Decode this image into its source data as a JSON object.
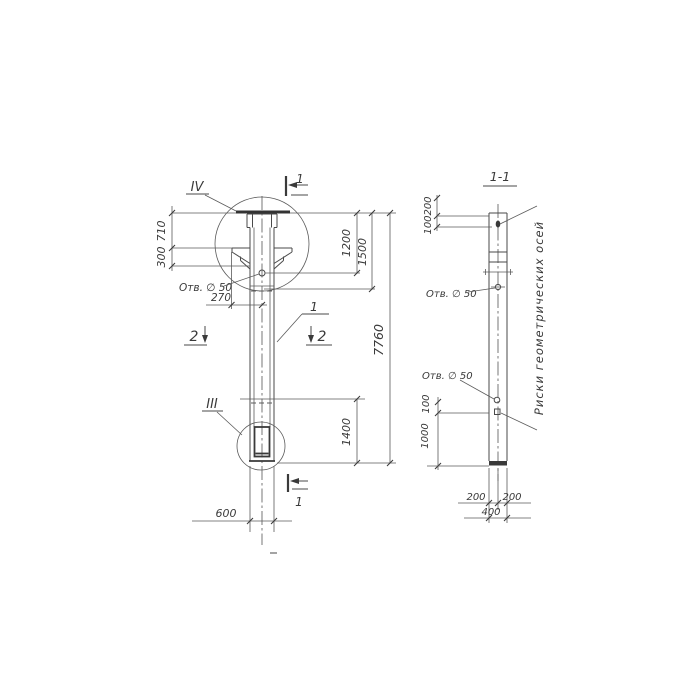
{
  "drawing": {
    "ink": "#3a3a3a",
    "main_view": {
      "detail_callout_top": "IV",
      "detail_callout_bottom": "III",
      "section_cut_top": "1",
      "section_cut_bottom": "1",
      "section_cut_left": "2",
      "section_cut_right": "2",
      "part_label": "1",
      "hole_label": "Отв. ∅ 50",
      "dims": {
        "d710": "710",
        "d300": "300",
        "d270": "270",
        "d1200": "1200",
        "d1500": "1500",
        "d7760": "7760",
        "d1400": "1400",
        "d600": "600"
      }
    },
    "section_view": {
      "title": "1-1",
      "hole_label_upper": "Отв. ∅ 50",
      "hole_label_lower": "Отв. ∅ 50",
      "axis_note": "Риски геометрических осей",
      "dims": {
        "d200_top": "200",
        "d100_top": "100",
        "d100_bottom": "100",
        "d1000": "1000",
        "d200_bottom_left": "200",
        "d200_bottom_right": "200",
        "d400": "400"
      }
    }
  }
}
